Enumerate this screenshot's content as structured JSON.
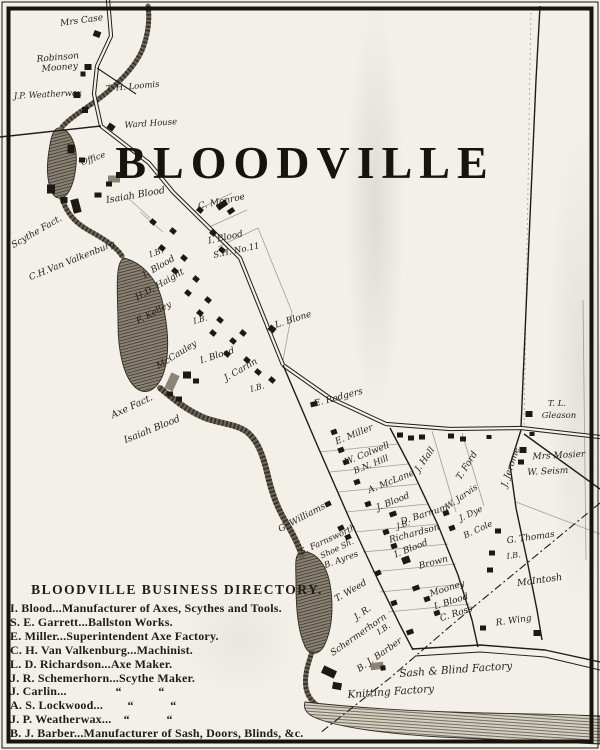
{
  "map": {
    "title": "BLOODVILLE",
    "directory": {
      "title": "BLOODVILLE BUSINESS DIRECTORY.",
      "entries": [
        "I. Blood...Manufacturer of Axes, Scythes and Tools.",
        "S. E. Garrett...Ballston Works.",
        "E. Miller...Superintendent Axe Factory.",
        "C. H. Van Valkenburg...Machinist.",
        "L. D. Richardson...Axe Maker.",
        "J. R. Schemerhorn...Scythe Maker.",
        "J. Carlin...    “   “",
        "A. S. Lockwood...  “   “",
        "J. P. Weatherwax... “   “",
        "B. J. Barber...Manufacturer of Sash, Doors, Blinds, &c."
      ]
    },
    "ink": "#1f1c17",
    "paper": "#f3f0e9",
    "labels": [
      {
        "t": "Mrs Case",
        "x": 82,
        "y": 23,
        "r": -8,
        "s": 9
      },
      {
        "t": "Robinson",
        "x": 58,
        "y": 60,
        "r": -5,
        "s": 9
      },
      {
        "t": "Mooney",
        "x": 60,
        "y": 70,
        "r": -5,
        "s": 9
      },
      {
        "t": "T. H. Loomis",
        "x": 133,
        "y": 89,
        "r": -5,
        "s": 8.5
      },
      {
        "t": "J.P. Weatherwax",
        "x": 48,
        "y": 97,
        "r": -3,
        "s": 8.5
      },
      {
        "t": "Ward House",
        "x": 151,
        "y": 126,
        "r": -4,
        "s": 8.5
      },
      {
        "t": "Office",
        "x": 94,
        "y": 161,
        "r": -20,
        "s": 8.5
      },
      {
        "t": "Isaiah Blood",
        "x": 136,
        "y": 198,
        "r": -10,
        "s": 9.5
      },
      {
        "t": "Scythe Fact.",
        "x": 38,
        "y": 234,
        "r": -30,
        "s": 9
      },
      {
        "t": "C.H.Van Valkenburg",
        "x": 73,
        "y": 263,
        "r": -22,
        "s": 9
      },
      {
        "t": "C. Monroe",
        "x": 222,
        "y": 204,
        "r": -12,
        "s": 9
      },
      {
        "t": "I. Blood",
        "x": 226,
        "y": 240,
        "r": -12,
        "s": 9
      },
      {
        "t": "S.H. No.11",
        "x": 237,
        "y": 253,
        "r": -12,
        "s": 8.5
      },
      {
        "t": "I.B.",
        "x": 157,
        "y": 255,
        "r": -20,
        "s": 8
      },
      {
        "t": "I. Blood",
        "x": 160,
        "y": 269,
        "r": -30,
        "s": 9
      },
      {
        "t": "H.D. Haight",
        "x": 161,
        "y": 287,
        "r": -30,
        "s": 9
      },
      {
        "t": "F. Kelley",
        "x": 155,
        "y": 315,
        "r": -28,
        "s": 9
      },
      {
        "t": "I.B.",
        "x": 201,
        "y": 322,
        "r": -15,
        "s": 8
      },
      {
        "t": "McCauley",
        "x": 178,
        "y": 357,
        "r": -32,
        "s": 9
      },
      {
        "t": "I. Blood",
        "x": 218,
        "y": 358,
        "r": -18,
        "s": 9
      },
      {
        "t": "J. Carlin",
        "x": 242,
        "y": 372,
        "r": -30,
        "s": 9
      },
      {
        "t": "I.B.",
        "x": 258,
        "y": 390,
        "r": -15,
        "s": 8
      },
      {
        "t": "L. Blone",
        "x": 294,
        "y": 322,
        "r": -18,
        "s": 9
      },
      {
        "t": "Axe Fact.",
        "x": 133,
        "y": 409,
        "r": -25,
        "s": 9.5
      },
      {
        "t": "Isaiah Blood",
        "x": 153,
        "y": 432,
        "r": -22,
        "s": 9.5
      },
      {
        "t": "E. Rodgers",
        "x": 339,
        "y": 400,
        "r": -15,
        "s": 9
      },
      {
        "t": "E. Miller",
        "x": 355,
        "y": 437,
        "r": -22,
        "s": 9
      },
      {
        "t": "W. Colwell",
        "x": 368,
        "y": 456,
        "r": -22,
        "s": 9
      },
      {
        "t": "B.N. Hill",
        "x": 372,
        "y": 467,
        "r": -22,
        "s": 8.5
      },
      {
        "t": "A. McLane",
        "x": 392,
        "y": 484,
        "r": -22,
        "s": 9
      },
      {
        "t": "J. Blood",
        "x": 394,
        "y": 504,
        "r": -22,
        "s": 9
      },
      {
        "t": "D. Barnum",
        "x": 425,
        "y": 517,
        "r": -18,
        "s": 9
      },
      {
        "t": "J.B.",
        "x": 404,
        "y": 527,
        "r": -18,
        "s": 8
      },
      {
        "t": "Richardson",
        "x": 415,
        "y": 536,
        "r": -15,
        "s": 9
      },
      {
        "t": "I. Blood",
        "x": 412,
        "y": 551,
        "r": -22,
        "s": 9
      },
      {
        "t": "Brown",
        "x": 434,
        "y": 565,
        "r": -15,
        "s": 9
      },
      {
        "t": "Mooney",
        "x": 448,
        "y": 591,
        "r": -18,
        "s": 9
      },
      {
        "t": "I. Blood",
        "x": 452,
        "y": 604,
        "r": -18,
        "s": 9
      },
      {
        "t": "C. Ross",
        "x": 457,
        "y": 616,
        "r": -18,
        "s": 9
      },
      {
        "t": "W. Jarvis",
        "x": 463,
        "y": 499,
        "r": -35,
        "s": 8.5
      },
      {
        "t": "J. Dye",
        "x": 472,
        "y": 516,
        "r": -25,
        "s": 8.5
      },
      {
        "t": "B. Cole",
        "x": 479,
        "y": 532,
        "r": -25,
        "s": 8.5
      },
      {
        "t": "J. Hall",
        "x": 427,
        "y": 461,
        "r": -55,
        "s": 9
      },
      {
        "t": "T. Ford",
        "x": 469,
        "y": 467,
        "r": -58,
        "s": 9
      },
      {
        "t": "J. Jerome",
        "x": 513,
        "y": 468,
        "r": -72,
        "s": 9
      },
      {
        "t": "T. L.",
        "x": 557,
        "y": 406,
        "r": 0,
        "s": 8.5
      },
      {
        "t": "Gleason",
        "x": 559,
        "y": 418,
        "r": 0,
        "s": 8.5
      },
      {
        "t": "Mrs Mosier",
        "x": 559,
        "y": 458,
        "r": -3,
        "s": 9
      },
      {
        "t": "W. Seism",
        "x": 548,
        "y": 474,
        "r": -3,
        "s": 9
      },
      {
        "t": "G. Thomas",
        "x": 531,
        "y": 540,
        "r": -8,
        "s": 9
      },
      {
        "t": "I.B.",
        "x": 514,
        "y": 558,
        "r": -8,
        "s": 8
      },
      {
        "t": "McIntosh",
        "x": 540,
        "y": 583,
        "r": -8,
        "s": 9.5
      },
      {
        "t": "R. Wing",
        "x": 514,
        "y": 623,
        "r": -8,
        "s": 9
      },
      {
        "t": "G. Williams",
        "x": 303,
        "y": 520,
        "r": -28,
        "s": 9
      },
      {
        "t": "S. Farnsworth",
        "x": 329,
        "y": 542,
        "r": -25,
        "s": 8.5
      },
      {
        "t": "Shoe Sh.",
        "x": 338,
        "y": 551,
        "r": -25,
        "s": 8
      },
      {
        "t": "B. Ayres",
        "x": 342,
        "y": 562,
        "r": -20,
        "s": 8.5
      },
      {
        "t": "T. Weed",
        "x": 352,
        "y": 593,
        "r": -30,
        "s": 9
      },
      {
        "t": "J. R.",
        "x": 364,
        "y": 615,
        "r": -35,
        "s": 9
      },
      {
        "t": "Schermerhorn",
        "x": 360,
        "y": 637,
        "r": -35,
        "s": 9
      },
      {
        "t": "I.B.",
        "x": 385,
        "y": 631,
        "r": -35,
        "s": 8
      },
      {
        "t": "B. J. Barber",
        "x": 381,
        "y": 657,
        "r": -35,
        "s": 9
      },
      {
        "t": "Sash & Blind Factory",
        "x": 456,
        "y": 673,
        "r": -4,
        "s": 10.5
      },
      {
        "t": "Knitting Factory",
        "x": 391,
        "y": 695,
        "r": -4,
        "s": 10.5
      }
    ],
    "roads": [
      {
        "name": "main-street-north",
        "pts": "108,0 111,36 97,66 94,94 101,126 149,163 173,192 240,258 283,365",
        "w": 1.6,
        "dbl": true
      },
      {
        "name": "main-street-east",
        "pts": "283,365 330,398 386,424 450,429 521,428 600,437",
        "w": 1.6,
        "dbl": true
      },
      {
        "name": "west-road",
        "pts": "0,137 101,126",
        "w": 1.4
      },
      {
        "name": "loomis-spur",
        "pts": "97,68 136,94",
        "w": 1.1
      },
      {
        "name": "village-street-west",
        "pts": "283,365 318,447 350,520 378,580 400,625 413,650",
        "w": 1.4
      },
      {
        "name": "village-street-east",
        "pts": "390,428 412,470 438,525 458,575 472,620 478,647",
        "w": 1.4
      },
      {
        "name": "jerome-road-north",
        "pts": "540,6 536,80 529,240 521,427",
        "w": 1.4
      },
      {
        "name": "jerome-road-south",
        "pts": "521,430 510,465 516,508 527,560 537,610 542,640",
        "w": 1.4
      },
      {
        "name": "southeast-road",
        "pts": "524,434 600,489",
        "w": 1.4
      },
      {
        "name": "bottom-road",
        "pts": "412,649 480,645 545,650 600,662",
        "w": 1.4
      },
      {
        "name": "bottom-road-edge",
        "pts": "415,656 480,652 545,657 600,670",
        "w": 0.9
      },
      {
        "name": "town-line-dashed",
        "pts": "600,503 454,623 390,678 320,733",
        "w": 1.1,
        "dash": "8 3 2 3"
      }
    ],
    "lot_lines": [
      {
        "pts": "531,8 524,427",
        "dash": "2 3"
      },
      {
        "pts": "195,211 232,193"
      },
      {
        "pts": "207,228 247,210"
      },
      {
        "pts": "218,247 258,228"
      },
      {
        "pts": "258,228 292,312"
      },
      {
        "pts": "292,312 283,360"
      },
      {
        "pts": "150,218 128,198"
      },
      {
        "pts": "163,232 140,212"
      },
      {
        "pts": "320,452 398,444"
      },
      {
        "pts": "330,472 408,464"
      },
      {
        "pts": "338,492 418,484"
      },
      {
        "pts": "346,512 428,504"
      },
      {
        "pts": "355,532 438,524"
      },
      {
        "pts": "363,552 448,544"
      },
      {
        "pts": "372,572 456,564"
      },
      {
        "pts": "380,592 464,584"
      },
      {
        "pts": "388,612 470,604"
      },
      {
        "pts": "432,431 456,512"
      },
      {
        "pts": "462,433 484,506"
      },
      {
        "pts": "516,502 600,534"
      },
      {
        "pts": "583,300 586,560"
      }
    ],
    "water": {
      "ponds": [
        "M60,128 C70,130 78,145 76,165 C74,188 66,200 58,198 C50,196 46,178 48,158 C50,142 52,127 60,128 Z",
        "M124,258 C140,262 156,276 162,300 C168,326 170,352 164,372 C158,390 146,396 136,388 C124,378 118,352 118,324 C118,298 114,262 124,258 Z",
        "M300,552 C314,550 326,562 330,584 C334,608 332,630 324,646 C318,656 308,656 304,644 C298,630 296,606 296,584 C296,566 294,556 300,552 Z"
      ],
      "streams": [
        {
          "d": "M148,6 C150,20 148,34 143,48 C136,66 118,84 100,98 C88,107 72,116 62,127",
          "w": 5
        },
        {
          "d": "M62,198 C66,212 74,222 88,230 C100,237 114,244 122,256",
          "w": 5
        },
        {
          "d": "M160,388 C172,398 186,410 205,418 C222,424 236,424 247,432 C258,441 263,456 267,472 C271,490 276,506 287,524 C294,536 299,546 302,556",
          "w": 6
        },
        {
          "d": "M312,652 C308,664 304,676 306,688 C308,698 314,704 322,708",
          "w": 5
        }
      ],
      "band": "M305,702 C340,706 390,710 450,712 C510,714 560,714 600,716 L600,744 C560,742 500,740 440,737 C390,734 340,728 316,718 C306,714 303,708 305,702 Z"
    },
    "buildings": [
      [
        97,
        34,
        7,
        6,
        20
      ],
      [
        88,
        67,
        7,
        6,
        0
      ],
      [
        83,
        74,
        5,
        5,
        0
      ],
      [
        77,
        95,
        7,
        6,
        0
      ],
      [
        85,
        110,
        6,
        6,
        0
      ],
      [
        111,
        127,
        7,
        6,
        35
      ],
      [
        71,
        149,
        7,
        9,
        0
      ],
      [
        82,
        160,
        6,
        5,
        0
      ],
      [
        51,
        189,
        8,
        9,
        0
      ],
      [
        98,
        195,
        7,
        5,
        0
      ],
      [
        114,
        179,
        12,
        7,
        0,
        "g"
      ],
      [
        119,
        175,
        6,
        6,
        0
      ],
      [
        109,
        184,
        6,
        5,
        0
      ],
      [
        222,
        205,
        11,
        6,
        -35
      ],
      [
        231,
        211,
        7,
        5,
        -35
      ],
      [
        64,
        200,
        7,
        6,
        0
      ],
      [
        76,
        206,
        8,
        14,
        -15
      ],
      [
        153,
        222,
        6,
        5,
        40
      ],
      [
        173,
        231,
        6,
        5,
        40
      ],
      [
        162,
        248,
        6,
        5,
        40
      ],
      [
        184,
        258,
        6,
        5,
        40
      ],
      [
        175,
        271,
        6,
        5,
        40
      ],
      [
        196,
        279,
        6,
        5,
        40
      ],
      [
        188,
        293,
        6,
        5,
        40
      ],
      [
        208,
        300,
        6,
        5,
        40
      ],
      [
        200,
        313,
        6,
        5,
        40
      ],
      [
        220,
        320,
        6,
        5,
        40
      ],
      [
        213,
        333,
        6,
        5,
        40
      ],
      [
        233,
        341,
        6,
        5,
        40
      ],
      [
        227,
        354,
        6,
        5,
        40
      ],
      [
        247,
        360,
        6,
        5,
        40
      ],
      [
        258,
        372,
        6,
        5,
        40
      ],
      [
        272,
        380,
        6,
        5,
        40
      ],
      [
        200,
        210,
        6,
        5,
        40
      ],
      [
        213,
        233,
        6,
        5,
        40
      ],
      [
        222,
        250,
        6,
        5,
        40
      ],
      [
        272,
        329,
        7,
        6,
        40
      ],
      [
        243,
        333,
        6,
        5,
        40
      ],
      [
        172,
        382,
        9,
        17,
        25,
        "g"
      ],
      [
        187,
        375,
        8,
        7,
        0
      ],
      [
        196,
        381,
        6,
        5,
        0
      ],
      [
        170,
        394,
        6,
        5,
        0
      ],
      [
        179,
        399,
        6,
        5,
        0
      ],
      [
        314,
        404,
        7,
        5,
        -15
      ],
      [
        400,
        435,
        6,
        5,
        0
      ],
      [
        411,
        438,
        6,
        5,
        0
      ],
      [
        422,
        437,
        6,
        5,
        0
      ],
      [
        451,
        436,
        6,
        5,
        0
      ],
      [
        463,
        439,
        6,
        5,
        0
      ],
      [
        489,
        437,
        5,
        4,
        0
      ],
      [
        532,
        434,
        5,
        4,
        0
      ],
      [
        529,
        414,
        7,
        6,
        0
      ],
      [
        523,
        450,
        7,
        6,
        0
      ],
      [
        521,
        462,
        6,
        5,
        0
      ],
      [
        334,
        432,
        6,
        5,
        -20
      ],
      [
        341,
        450,
        6,
        5,
        -20
      ],
      [
        346,
        462,
        6,
        5,
        -20
      ],
      [
        357,
        482,
        6,
        5,
        -20
      ],
      [
        368,
        504,
        6,
        5,
        -20
      ],
      [
        393,
        514,
        7,
        5,
        -20
      ],
      [
        386,
        532,
        6,
        5,
        -20
      ],
      [
        394,
        546,
        6,
        5,
        -20
      ],
      [
        406,
        560,
        8,
        7,
        -20
      ],
      [
        416,
        588,
        7,
        5,
        -20
      ],
      [
        427,
        599,
        6,
        5,
        -20
      ],
      [
        437,
        613,
        6,
        5,
        -20
      ],
      [
        394,
        603,
        6,
        5,
        -20
      ],
      [
        410,
        632,
        7,
        5,
        -20
      ],
      [
        446,
        513,
        6,
        5,
        -20
      ],
      [
        452,
        528,
        6,
        5,
        -20
      ],
      [
        498,
        531,
        6,
        5,
        0
      ],
      [
        492,
        553,
        6,
        5,
        0
      ],
      [
        490,
        570,
        6,
        5,
        0
      ],
      [
        483,
        628,
        6,
        5,
        0
      ],
      [
        537,
        633,
        7,
        6,
        0
      ],
      [
        328,
        504,
        6,
        5,
        -25
      ],
      [
        341,
        528,
        6,
        5,
        -25
      ],
      [
        348,
        537,
        6,
        5,
        -25
      ],
      [
        378,
        573,
        6,
        5,
        -25
      ],
      [
        329,
        672,
        14,
        8,
        25
      ],
      [
        337,
        686,
        9,
        7,
        10
      ],
      [
        377,
        666,
        13,
        7,
        -8,
        "g"
      ],
      [
        383,
        668,
        5,
        5,
        -8
      ]
    ]
  }
}
